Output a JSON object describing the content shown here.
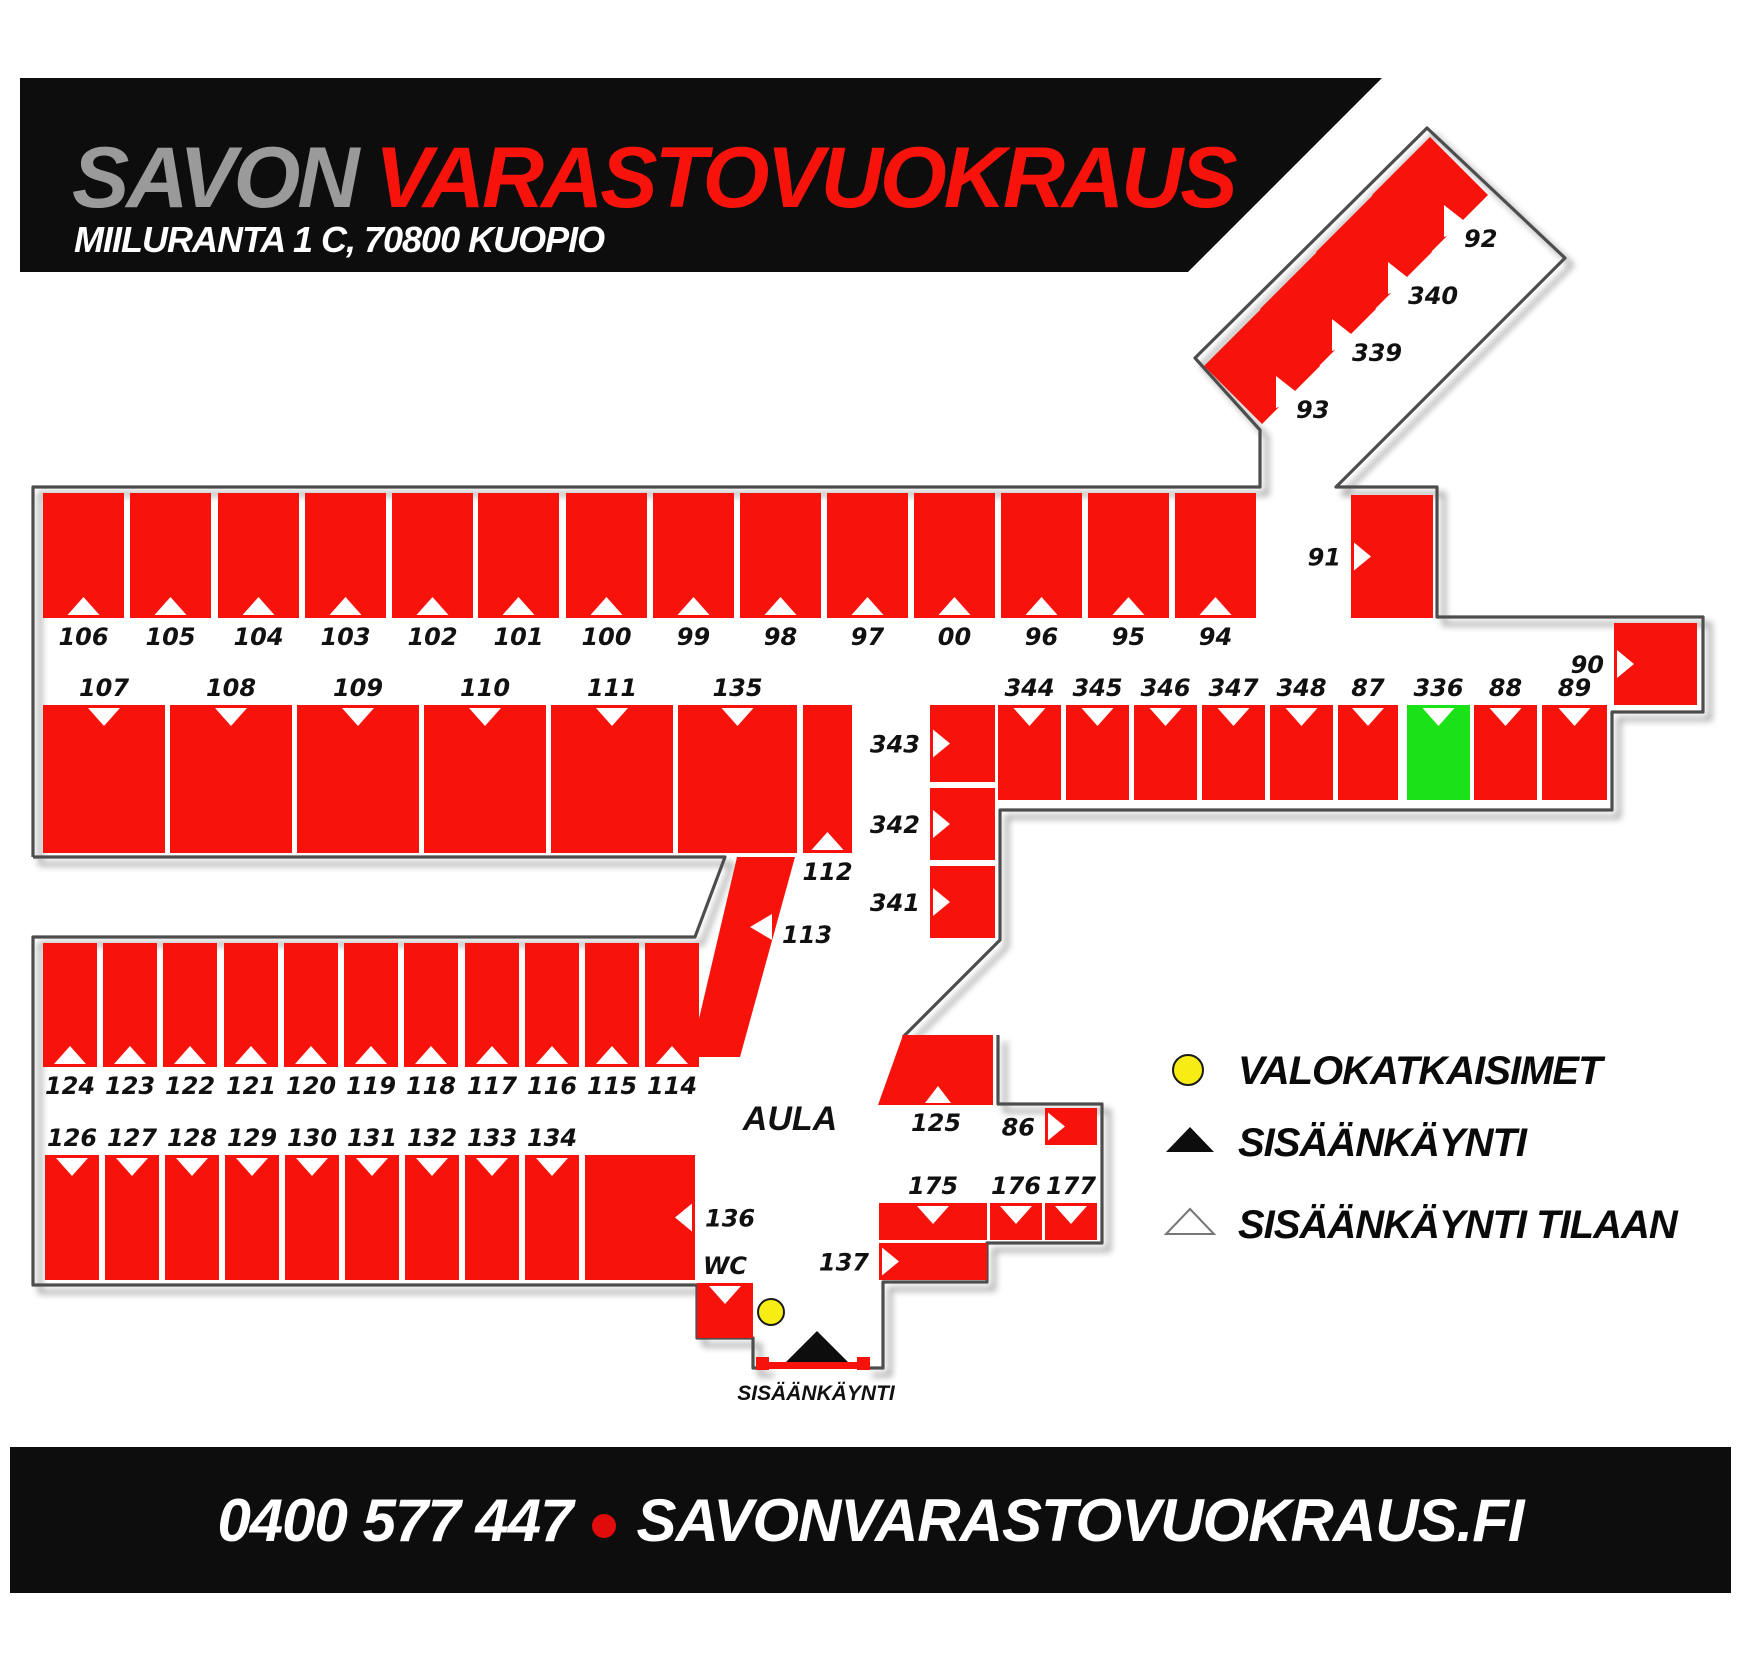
{
  "header": {
    "title_primary": "SAVON",
    "title_secondary": "VARASTOVUOKRAUS",
    "address": "MIILURANTA 1 C, 70800 KUOPIO"
  },
  "footer": {
    "phone": "0400 577 447",
    "website": "SAVONVARASTOVUOKRAUS.FI"
  },
  "legend": {
    "valokatkaisimet": "VALOKATKAISIMET",
    "sisaankaynti": "SISÄÄNKÄYNTI",
    "sisaankaynti_tilaan": "SISÄÄNKÄYNTI TILAAN"
  },
  "map_labels": {
    "aula": "AULA",
    "entrance": "SISÄÄNKÄYNTI"
  },
  "colors": {
    "unit_red": "#F7130B",
    "unit_free_green": "#1BE117",
    "wall_gray": "#4d4d4d",
    "switch_yellow": "#F7EC13",
    "header_black": "#0d0d0d",
    "title_gray": "#9a9a9a",
    "title_red": "#F7130B",
    "marker_white": "#ffffff"
  },
  "units": [
    {
      "id": "106",
      "x": 43,
      "y": 493,
      "w": 81,
      "h": 125,
      "tri": "up",
      "label": "below"
    },
    {
      "id": "105",
      "x": 130,
      "y": 493,
      "w": 81,
      "h": 125,
      "tri": "up",
      "label": "below"
    },
    {
      "id": "104",
      "x": 218,
      "y": 493,
      "w": 81,
      "h": 125,
      "tri": "up",
      "label": "below"
    },
    {
      "id": "103",
      "x": 305,
      "y": 493,
      "w": 81,
      "h": 125,
      "tri": "up",
      "label": "below"
    },
    {
      "id": "102",
      "x": 392,
      "y": 493,
      "w": 81,
      "h": 125,
      "tri": "up",
      "label": "below"
    },
    {
      "id": "101",
      "x": 478,
      "y": 493,
      "w": 81,
      "h": 125,
      "tri": "up",
      "label": "below"
    },
    {
      "id": "100",
      "x": 566,
      "y": 493,
      "w": 81,
      "h": 125,
      "tri": "up",
      "label": "below"
    },
    {
      "id": "99",
      "x": 653,
      "y": 493,
      "w": 81,
      "h": 125,
      "tri": "up",
      "label": "below"
    },
    {
      "id": "98",
      "x": 740,
      "y": 493,
      "w": 81,
      "h": 125,
      "tri": "up",
      "label": "below"
    },
    {
      "id": "97",
      "x": 827,
      "y": 493,
      "w": 81,
      "h": 125,
      "tri": "up",
      "label": "below"
    },
    {
      "id": "00",
      "x": 914,
      "y": 493,
      "w": 81,
      "h": 125,
      "tri": "up",
      "label": "below"
    },
    {
      "id": "96",
      "x": 1001,
      "y": 493,
      "w": 81,
      "h": 125,
      "tri": "up",
      "label": "below"
    },
    {
      "id": "95",
      "x": 1088,
      "y": 493,
      "w": 81,
      "h": 125,
      "tri": "up",
      "label": "below"
    },
    {
      "id": "94",
      "x": 1175,
      "y": 493,
      "w": 81,
      "h": 125,
      "tri": "up",
      "label": "below"
    },
    {
      "id": "107",
      "x": 43,
      "y": 705,
      "w": 122,
      "h": 148,
      "tri": "down",
      "label": "above"
    },
    {
      "id": "108",
      "x": 170,
      "y": 705,
      "w": 122,
      "h": 148,
      "tri": "down",
      "label": "above"
    },
    {
      "id": "109",
      "x": 297,
      "y": 705,
      "w": 122,
      "h": 148,
      "tri": "down",
      "label": "above"
    },
    {
      "id": "110",
      "x": 424,
      "y": 705,
      "w": 122,
      "h": 148,
      "tri": "down",
      "label": "above"
    },
    {
      "id": "111",
      "x": 551,
      "y": 705,
      "w": 122,
      "h": 148,
      "tri": "down",
      "label": "above"
    },
    {
      "id": "135",
      "x": 678,
      "y": 705,
      "w": 119,
      "h": 148,
      "tri": "down",
      "label": "above"
    },
    {
      "id": "112",
      "x": 803,
      "y": 705,
      "w": 49,
      "h": 148,
      "tri": "up",
      "label": "below"
    },
    {
      "id": "113",
      "shape": "poly",
      "points": "737,857 795,857 740,1057 690,1057",
      "tri_points": "772,914 772,940 750,927",
      "label": "custom",
      "lx": 782,
      "ly": 943,
      "anchor": "start"
    },
    {
      "id": "343",
      "x": 930,
      "y": 705,
      "w": 65,
      "h": 77,
      "tri": "right",
      "label": "left"
    },
    {
      "id": "342",
      "x": 930,
      "y": 788,
      "w": 65,
      "h": 72,
      "tri": "right",
      "label": "left"
    },
    {
      "id": "341",
      "x": 930,
      "y": 866,
      "w": 65,
      "h": 72,
      "tri": "right",
      "label": "left"
    },
    {
      "id": "344",
      "x": 998,
      "y": 705,
      "w": 63,
      "h": 95,
      "tri": "down",
      "label": "above"
    },
    {
      "id": "345",
      "x": 1066,
      "y": 705,
      "w": 63,
      "h": 95,
      "tri": "down",
      "label": "above"
    },
    {
      "id": "346",
      "x": 1134,
      "y": 705,
      "w": 63,
      "h": 95,
      "tri": "down",
      "label": "above"
    },
    {
      "id": "347",
      "x": 1202,
      "y": 705,
      "w": 63,
      "h": 95,
      "tri": "down",
      "label": "above"
    },
    {
      "id": "348",
      "x": 1270,
      "y": 705,
      "w": 63,
      "h": 95,
      "tri": "down",
      "label": "above"
    },
    {
      "id": "87",
      "x": 1338,
      "y": 705,
      "w": 60,
      "h": 95,
      "tri": "down",
      "label": "above"
    },
    {
      "id": "336",
      "x": 1407,
      "y": 705,
      "w": 63,
      "h": 95,
      "tri": "down",
      "label": "above",
      "fill": "green"
    },
    {
      "id": "88",
      "x": 1474,
      "y": 705,
      "w": 63,
      "h": 95,
      "tri": "down",
      "label": "above"
    },
    {
      "id": "89",
      "x": 1542,
      "y": 705,
      "w": 65,
      "h": 95,
      "tri": "down",
      "label": "above"
    },
    {
      "id": "91",
      "x": 1351,
      "y": 495,
      "w": 82,
      "h": 123,
      "tri": "right",
      "label": "left"
    },
    {
      "id": "90",
      "x": 1614,
      "y": 623,
      "w": 83,
      "h": 82,
      "tri": "right",
      "label": "left"
    },
    {
      "id": "93",
      "shape": "diamond",
      "cx": 1262,
      "cy": 366,
      "r": 58,
      "label": "diamond"
    },
    {
      "id": "339",
      "shape": "diamond",
      "cx": 1318,
      "cy": 309,
      "r": 58,
      "label": "diamond"
    },
    {
      "id": "340",
      "shape": "diamond",
      "cx": 1374,
      "cy": 252,
      "r": 58,
      "label": "diamond"
    },
    {
      "id": "92",
      "shape": "diamond",
      "cx": 1430,
      "cy": 195,
      "r": 58,
      "label": "diamond"
    },
    {
      "id": "124",
      "x": 43,
      "y": 943,
      "w": 54,
      "h": 124,
      "tri": "up",
      "label": "below"
    },
    {
      "id": "123",
      "x": 103,
      "y": 943,
      "w": 54,
      "h": 124,
      "tri": "up",
      "label": "below"
    },
    {
      "id": "122",
      "x": 163,
      "y": 943,
      "w": 54,
      "h": 124,
      "tri": "up",
      "label": "below"
    },
    {
      "id": "121",
      "x": 224,
      "y": 943,
      "w": 54,
      "h": 124,
      "tri": "up",
      "label": "below"
    },
    {
      "id": "120",
      "x": 284,
      "y": 943,
      "w": 54,
      "h": 124,
      "tri": "up",
      "label": "below"
    },
    {
      "id": "119",
      "x": 344,
      "y": 943,
      "w": 54,
      "h": 124,
      "tri": "up",
      "label": "below"
    },
    {
      "id": "118",
      "x": 404,
      "y": 943,
      "w": 54,
      "h": 124,
      "tri": "up",
      "label": "below"
    },
    {
      "id": "117",
      "x": 465,
      "y": 943,
      "w": 54,
      "h": 124,
      "tri": "up",
      "label": "below"
    },
    {
      "id": "116",
      "x": 525,
      "y": 943,
      "w": 54,
      "h": 124,
      "tri": "up",
      "label": "below"
    },
    {
      "id": "115",
      "x": 585,
      "y": 943,
      "w": 54,
      "h": 124,
      "tri": "up",
      "label": "below"
    },
    {
      "id": "114",
      "x": 645,
      "y": 943,
      "w": 54,
      "h": 124,
      "tri": "up",
      "label": "below"
    },
    {
      "id": "126",
      "x": 45,
      "y": 1155,
      "w": 54,
      "h": 125,
      "tri": "down",
      "label": "above"
    },
    {
      "id": "127",
      "x": 105,
      "y": 1155,
      "w": 54,
      "h": 125,
      "tri": "down",
      "label": "above"
    },
    {
      "id": "128",
      "x": 165,
      "y": 1155,
      "w": 54,
      "h": 125,
      "tri": "down",
      "label": "above"
    },
    {
      "id": "129",
      "x": 225,
      "y": 1155,
      "w": 54,
      "h": 125,
      "tri": "down",
      "label": "above"
    },
    {
      "id": "130",
      "x": 285,
      "y": 1155,
      "w": 54,
      "h": 125,
      "tri": "down",
      "label": "above"
    },
    {
      "id": "131",
      "x": 345,
      "y": 1155,
      "w": 54,
      "h": 125,
      "tri": "down",
      "label": "above"
    },
    {
      "id": "132",
      "x": 405,
      "y": 1155,
      "w": 54,
      "h": 125,
      "tri": "down",
      "label": "above"
    },
    {
      "id": "133",
      "x": 465,
      "y": 1155,
      "w": 54,
      "h": 125,
      "tri": "down",
      "label": "above"
    },
    {
      "id": "134",
      "x": 525,
      "y": 1155,
      "w": 54,
      "h": 125,
      "tri": "down",
      "label": "above"
    },
    {
      "id": "136",
      "x": 585,
      "y": 1155,
      "w": 110,
      "h": 125,
      "tri": "left",
      "label": "right"
    },
    {
      "id": "125",
      "shape": "poly",
      "points": "903,1035 993,1035 993,1105 878,1105",
      "tri_points": "925,1103 951,1103 938,1086",
      "label": "custom",
      "lx": 936,
      "ly": 1131,
      "anchor": "middle"
    },
    {
      "id": "86",
      "x": 1045,
      "y": 1108,
      "w": 52,
      "h": 37,
      "tri": "right",
      "label": "left"
    },
    {
      "id": "175",
      "x": 879,
      "y": 1203,
      "w": 108,
      "h": 37,
      "tri": "down",
      "label": "above"
    },
    {
      "id": "176",
      "x": 990,
      "y": 1203,
      "w": 52,
      "h": 37,
      "tri": "down",
      "label": "above"
    },
    {
      "id": "177",
      "x": 1045,
      "y": 1203,
      "w": 52,
      "h": 37,
      "tri": "down",
      "label": "above"
    },
    {
      "id": "137",
      "x": 879,
      "y": 1243,
      "w": 108,
      "h": 37,
      "tri": "right",
      "label": "left"
    },
    {
      "id": "WC",
      "x": 697,
      "y": 1283,
      "w": 56,
      "h": 55,
      "tri": "down",
      "label": "above",
      "facility": true
    }
  ]
}
